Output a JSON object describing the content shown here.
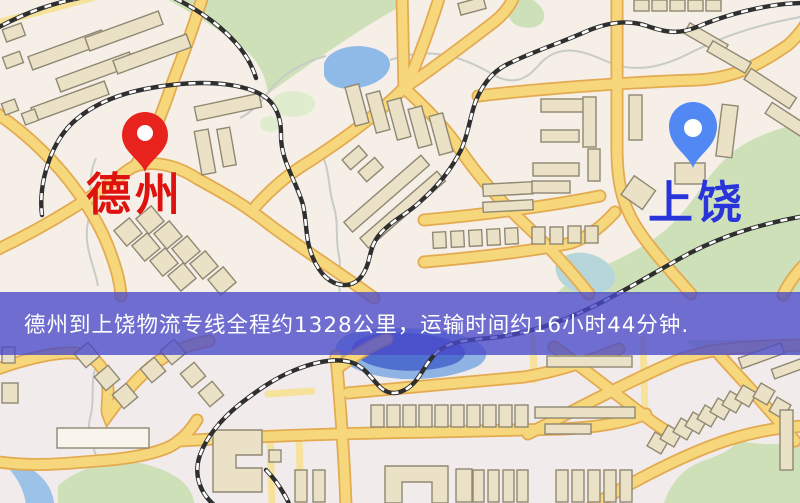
{
  "banner": {
    "text": "德州到上饶物流专线全程约1328公里，运输时间约16小时44分钟.",
    "background_color": "#4949c9",
    "text_color": "#ffffff"
  },
  "markers": [
    {
      "id": "origin",
      "label": "德州",
      "label_color": "#de1310",
      "pin_color": "#e8231d"
    },
    {
      "id": "destination",
      "label": "上饶",
      "label_color": "#2a35d9",
      "pin_color": "#5288f4"
    }
  ],
  "map_colors": {
    "background": "#f5efe8",
    "road_fill": "#f7d77c",
    "road_casing": "#e3aa50",
    "building_fill": "#eae1c6",
    "green_area": "#cde0b8",
    "water": "#8fb9e6",
    "lake_deep": "#4f70cf",
    "railway": "#2f2f2f"
  }
}
